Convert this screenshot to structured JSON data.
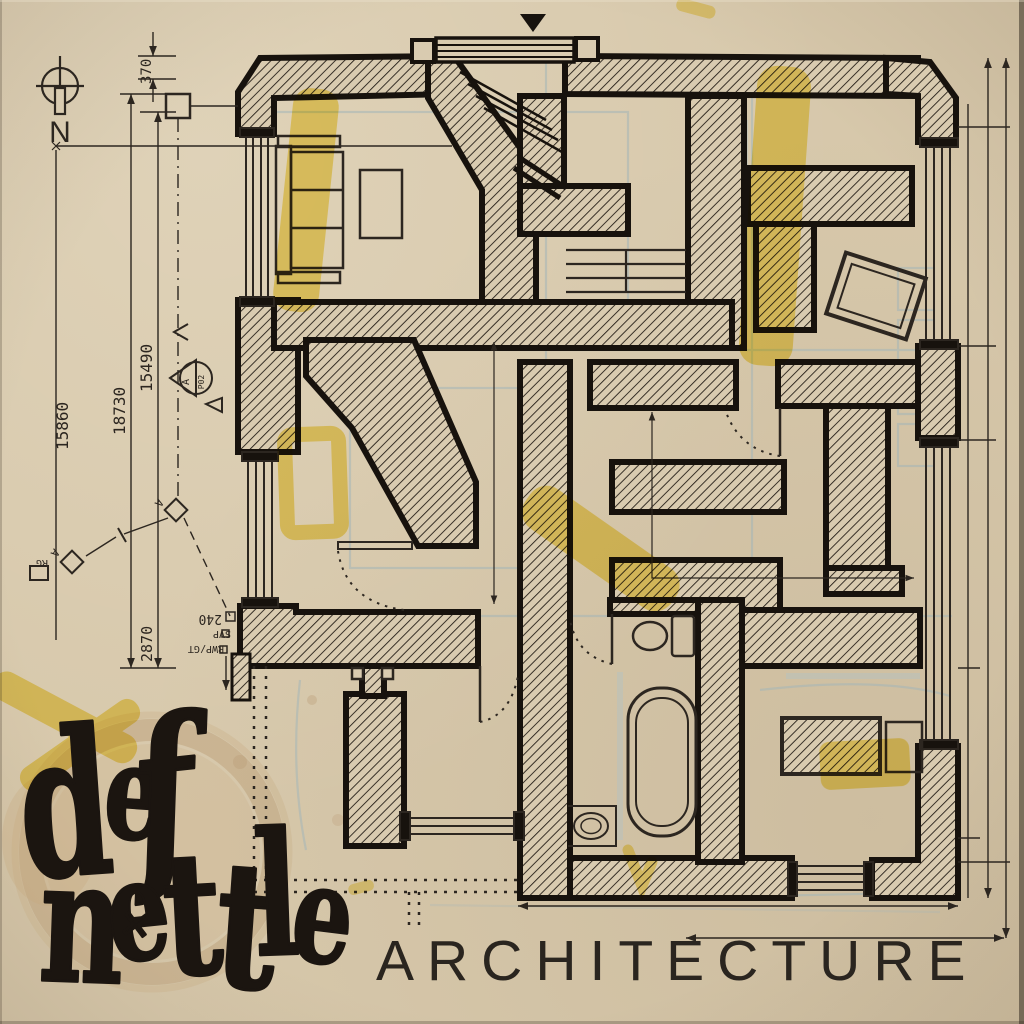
{
  "compass": {
    "label": "N"
  },
  "dimensions": {
    "d370": "370",
    "d15490": "15490",
    "d18730": "18730",
    "d15860": "15860",
    "d2870": "2870",
    "d240": "240",
    "svp": "SVP",
    "rwp": "RWP/GT"
  },
  "markers": {
    "section_letter": "A",
    "section_ref": "P02",
    "gully": "RG",
    "rwp_a": "A",
    "rwp_a2": "A"
  },
  "logo": {
    "line1": [
      "d",
      "e",
      "f"
    ],
    "line2": [
      "n",
      "e",
      "t",
      "t",
      "l",
      "e"
    ],
    "cross": "✕"
  },
  "title": {
    "text": "ARCHITECTURE"
  },
  "colors": {
    "paper": "#d7c8ab",
    "ink": "#2c2620",
    "wall": "#17120d",
    "pencil": "#a4b6b8",
    "highlighter": "#f0d431",
    "stain": "#b79871",
    "title_ink": "#2a251f"
  }
}
